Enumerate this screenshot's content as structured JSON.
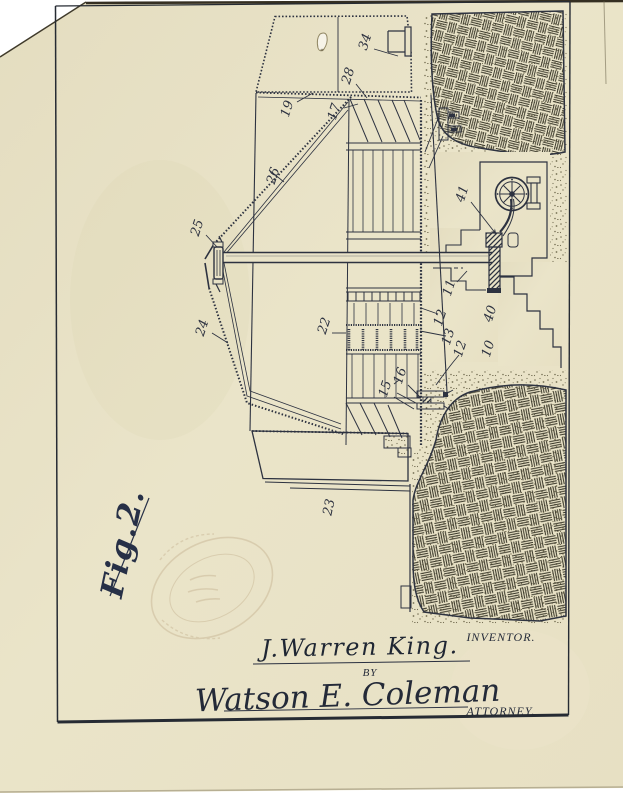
{
  "figure": {
    "caption": "Fig.2.",
    "ref_numerals": [
      "34",
      "28",
      "19",
      "17",
      "26",
      "25",
      "24",
      "22",
      "41",
      "11",
      "12",
      "13",
      "12",
      "40",
      "10",
      "16",
      "15",
      "23"
    ]
  },
  "signature_block": {
    "inventor_name": "J.Warren King.",
    "inventor_title": "INVENTOR.",
    "by_label": "BY",
    "attorney_name": "Watson E. Coleman",
    "attorney_title": "ATTORNEY."
  },
  "colors": {
    "paper": "#e8e2c6",
    "ink": "#2d3240",
    "hatch_ink": "#3b392b",
    "stamp": "#b49a74"
  }
}
